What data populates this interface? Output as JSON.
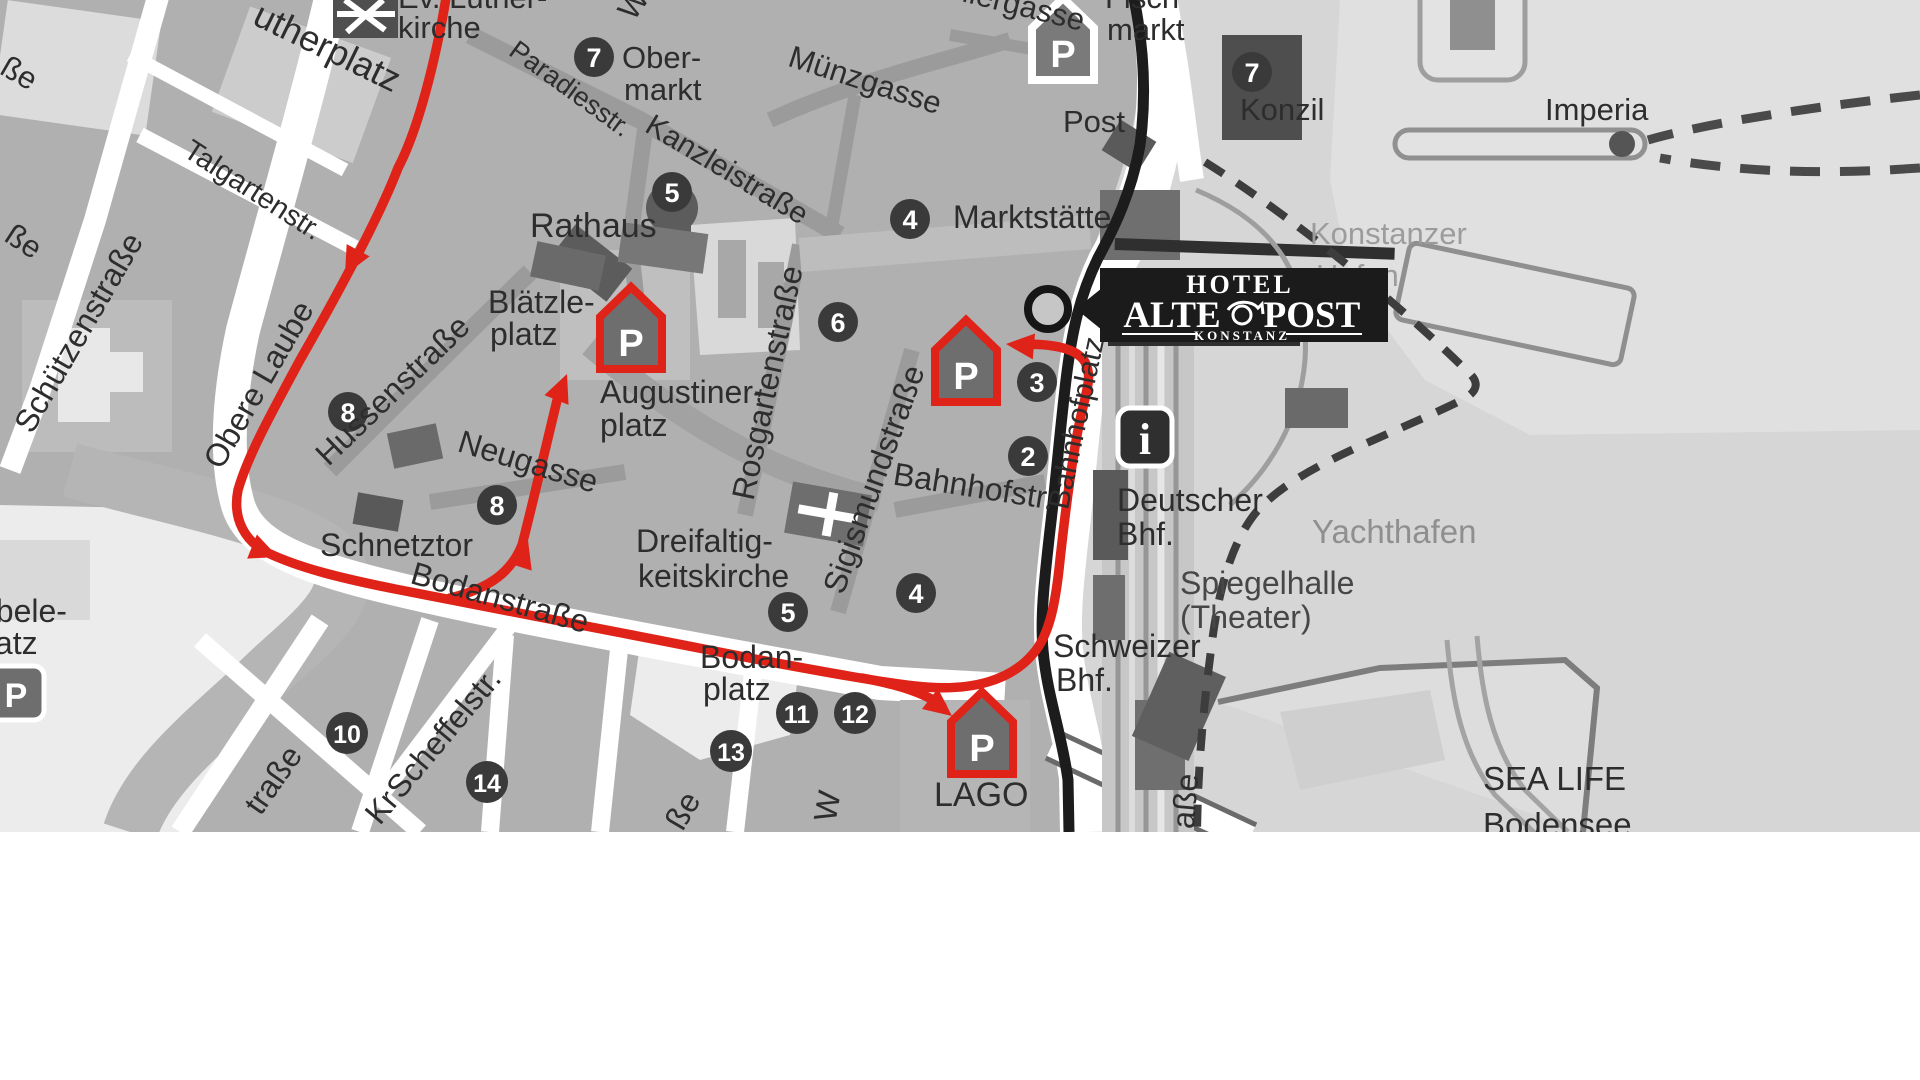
{
  "colors": {
    "route_red": "#e02318",
    "boundary_black": "#1c1c1c",
    "marker_bg": "#3a3a3a",
    "logo_bg": "#1b1b1b",
    "road_white": "#ffffff",
    "block_gray": "#b0b0b0",
    "water_gray": "#d6d6d6",
    "building_dark": "#5c5c5c",
    "label_dark": "#2d2d2d",
    "label_gray": "#9c9c9c"
  },
  "logo": {
    "line1": "HOTEL",
    "line2_left": "ALTE",
    "line2_right": "POST",
    "line3": "KONSTANZ"
  },
  "labels": {
    "lutherplatz": "utherplatz",
    "ev_luther": "Ev. Luther-",
    "kirche": "kirche",
    "obermarkt1": "Ober-",
    "obermarkt2": "markt",
    "paradiesstr": "Paradiesstr.",
    "kanzleistrasse": "Kanzleistraße",
    "muenzgasse": "Münzgasse",
    "ellergasse": "ellergasse",
    "fischmarkt1": "Fisch",
    "fischmarkt2": "markt",
    "post": "Post",
    "konzil": "Konzil",
    "imperia": "Imperia",
    "konstanzer": "Konstanzer",
    "hafen": "Hafen",
    "rathaus": "Rathaus",
    "marktstaette": "Marktstätte",
    "blaetzle1": "Blätzle-",
    "blaetzle2": "platz",
    "augustiner1": "Augustiner-",
    "augustiner2": "platz",
    "hussenstrasse": "Hussenstraße",
    "obere_laube": "Obere Laube",
    "schuetzenstrasse": "Schützenstraße",
    "talgartenstr": "Talgartenstr.",
    "neugasse": "Neugasse",
    "schnetztor": "Schnetztor",
    "rosgartenstrasse": "Rosgartenstraße",
    "sigismundstrasse": "Sigismundstraße",
    "bahnhofstr": "Bahnhofstr.",
    "bahnhofplatz": "Bahnhofplatz",
    "dreifaltig1": "Dreifaltig-",
    "dreifaltig2": "keitskirche",
    "deutscher_bhf1": "Deutscher",
    "deutscher_bhf2": "Bhf.",
    "schweizer_bhf1": "Schweizer",
    "schweizer_bhf2": "Bhf.",
    "yachthafen": "Yachthafen",
    "spiegelhalle1": "Spiegelhalle",
    "spiegelhalle2": "(Theater)",
    "bodanstrasse": "Bodanstraße",
    "bodanplatz1": "Bodan-",
    "bodanplatz2": "platz",
    "scheffelstr": "Scheffelstr.",
    "lago": "LAGO",
    "sealife1": "SEA LIFE",
    "sealife2": "Bodensee",
    "doebele1": "öbele-",
    "doebele2": "platz"
  },
  "fragments": {
    "f_sse_top": "ße",
    "f_sse_mid": "ße",
    "f_w_top": "W",
    "f_kr": "Kr",
    "f_trasse": "traße",
    "f_sse_bottom": "ße",
    "f_w_bottom": "W",
    "f_asse": "aße"
  },
  "markers": [
    {
      "label": "7"
    },
    {
      "label": "5"
    },
    {
      "label": "4"
    },
    {
      "label": "6"
    },
    {
      "label": "8"
    },
    {
      "label": "8"
    },
    {
      "label": "3"
    },
    {
      "label": "2"
    },
    {
      "label": "7"
    },
    {
      "label": "5"
    },
    {
      "label": "4"
    },
    {
      "label": "10"
    },
    {
      "label": "14"
    },
    {
      "label": "13"
    },
    {
      "label": "11"
    },
    {
      "label": "12"
    }
  ],
  "icons": {
    "parking_letter": "P",
    "parking_letter2": "P",
    "parking_letter3": "P",
    "parking_letter_top": "P",
    "parking_letter_doebele": "P",
    "info_letter": "i"
  }
}
